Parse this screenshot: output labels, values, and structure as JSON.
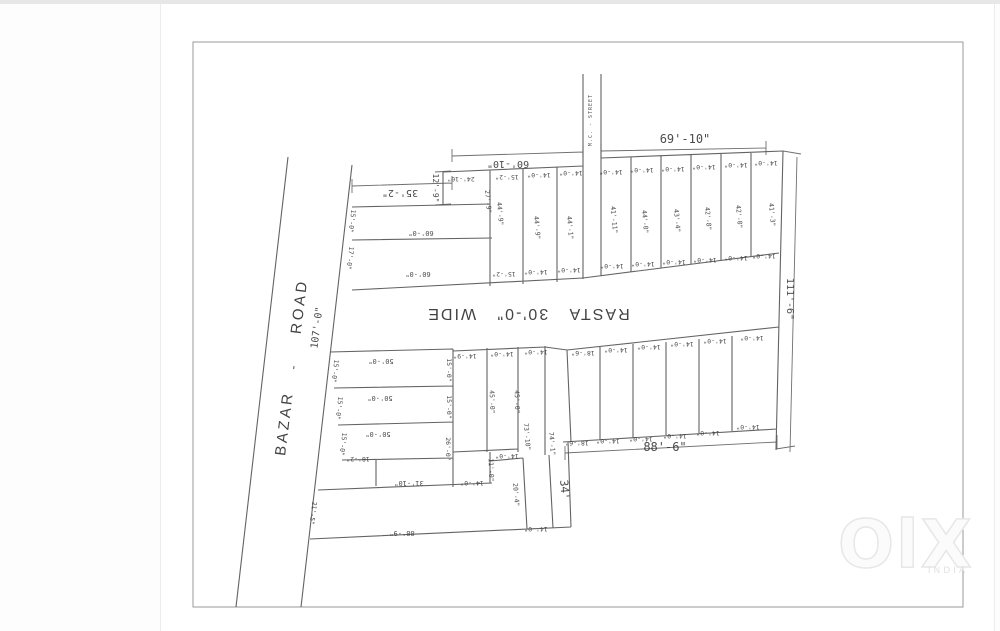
{
  "watermark": {
    "logo": "OlX",
    "country": "INDIA"
  },
  "plan": {
    "road_labels": [
      {
        "t": "BAZAR",
        "x": 289,
        "y": 424,
        "r": -83,
        "s": 15,
        "ls": 3,
        "c": "big"
      },
      {
        "t": "-",
        "x": 297,
        "y": 368,
        "r": -83,
        "s": 12,
        "c": "big"
      },
      {
        "t": "ROAD",
        "x": 304,
        "y": 307,
        "r": -83,
        "s": 15,
        "ls": 3,
        "c": "big"
      },
      {
        "t": "107'-0\"",
        "x": 320,
        "y": 328,
        "r": -83,
        "s": 10
      }
    ],
    "street_labels": [
      {
        "t": "M.C. - STREET",
        "x": 592,
        "y": 120,
        "r": -90,
        "s": 5,
        "ls": 1
      }
    ],
    "rasta_labels": [
      {
        "t": "RASTA   30'-0\"   WIDE",
        "x": 528,
        "y": 309,
        "r": 180,
        "s": 16,
        "ls": 2,
        "c": "big"
      }
    ],
    "boundary_dims": [
      {
        "t": "69'-10\"",
        "x": 685,
        "y": 143,
        "r": 0,
        "s": 12
      },
      {
        "t": "60'-10\"",
        "x": 508,
        "y": 161,
        "r": 180,
        "s": 10
      },
      {
        "t": "35'-2\"",
        "x": 400,
        "y": 190,
        "r": 180,
        "s": 10
      },
      {
        "t": "111'-6\"",
        "x": 787,
        "y": 299,
        "r": 90,
        "s": 10
      },
      {
        "t": "88'-6\"",
        "x": 665,
        "y": 451,
        "r": 0,
        "s": 12
      },
      {
        "t": "88'-9\"",
        "x": 402,
        "y": 531,
        "r": 180,
        "s": 7
      }
    ],
    "plot_labels": [
      {
        "t": "12'-9\"",
        "x": 433,
        "y": 188,
        "r": 90,
        "s": 8
      },
      {
        "t": "24'-10\"",
        "x": 461,
        "y": 177,
        "r": 180,
        "s": 6.5
      },
      {
        "t": "15'-2\"",
        "x": 507,
        "y": 175,
        "r": 180,
        "s": 6.5
      },
      {
        "t": "14'-0\"",
        "x": 539,
        "y": 173,
        "r": 180,
        "s": 6.5
      },
      {
        "t": "14'-0\"",
        "x": 571,
        "y": 171,
        "r": 180,
        "s": 6.5
      },
      {
        "t": "14'-0\"",
        "x": 611,
        "y": 170,
        "r": 180,
        "s": 6.5
      },
      {
        "t": "14'-0\"",
        "x": 642,
        "y": 168,
        "r": 180,
        "s": 6.5
      },
      {
        "t": "14'-0\"",
        "x": 673,
        "y": 167,
        "r": 180,
        "s": 6.5
      },
      {
        "t": "14'-0\"",
        "x": 704,
        "y": 165,
        "r": 180,
        "s": 6.5
      },
      {
        "t": "14'-0\"",
        "x": 736,
        "y": 163,
        "r": 180,
        "s": 6.5
      },
      {
        "t": "14'-0\"",
        "x": 766,
        "y": 161,
        "r": 180,
        "s": 6.5
      },
      {
        "t": "27'-9\"",
        "x": 486,
        "y": 202,
        "r": 85,
        "s": 6.5
      },
      {
        "t": "44'-9\"",
        "x": 498,
        "y": 214,
        "r": 85,
        "s": 6.5
      },
      {
        "t": "44'-9\"",
        "x": 535,
        "y": 228,
        "r": 85,
        "s": 6.5
      },
      {
        "t": "44'-1\"",
        "x": 568,
        "y": 228,
        "r": 85,
        "s": 6.5
      },
      {
        "t": "41'-11\"",
        "x": 612,
        "y": 220,
        "r": 85,
        "s": 6.5
      },
      {
        "t": "44'-0\"",
        "x": 643,
        "y": 222,
        "r": 85,
        "s": 6.5
      },
      {
        "t": "43'-4\"",
        "x": 675,
        "y": 221,
        "r": 85,
        "s": 6.5
      },
      {
        "t": "42'-8\"",
        "x": 706,
        "y": 219,
        "r": 85,
        "s": 6.5
      },
      {
        "t": "42'-0\"",
        "x": 737,
        "y": 217,
        "r": 85,
        "s": 6.5
      },
      {
        "t": "41'-3\"",
        "x": 770,
        "y": 215,
        "r": 85,
        "s": 6.5
      },
      {
        "t": "60'-0\"",
        "x": 421,
        "y": 231,
        "r": 180,
        "s": 7
      },
      {
        "t": "60'-0\"",
        "x": 418,
        "y": 272,
        "r": 180,
        "s": 7
      },
      {
        "t": "15'-0\"",
        "x": 350,
        "y": 221,
        "r": 97,
        "s": 6.5
      },
      {
        "t": "17'-0\"",
        "x": 348,
        "y": 258,
        "r": 97,
        "s": 6.5
      },
      {
        "t": "15'-2\"",
        "x": 504,
        "y": 272,
        "r": 180,
        "s": 6.5
      },
      {
        "t": "14'-0\"",
        "x": 536,
        "y": 270,
        "r": 180,
        "s": 6.5
      },
      {
        "t": "14'-0\"",
        "x": 569,
        "y": 268,
        "r": 180,
        "s": 6.5
      },
      {
        "t": "14'-0\"",
        "x": 612,
        "y": 264,
        "r": 180,
        "s": 6.5
      },
      {
        "t": "14'-0\"",
        "x": 643,
        "y": 262,
        "r": 180,
        "s": 6.5
      },
      {
        "t": "14'-0\"",
        "x": 674,
        "y": 260,
        "r": 180,
        "s": 6.5
      },
      {
        "t": "14'-0\"",
        "x": 705,
        "y": 258,
        "r": 180,
        "s": 6.5
      },
      {
        "t": "14'-0\"",
        "x": 736,
        "y": 256,
        "r": 180,
        "s": 6.5
      },
      {
        "t": "14'-0\"",
        "x": 764,
        "y": 254,
        "r": 180,
        "s": 6.5
      },
      {
        "t": "50'-0\"",
        "x": 381,
        "y": 359,
        "r": 180,
        "s": 7
      },
      {
        "t": "50'-0\"",
        "x": 380,
        "y": 396,
        "r": 180,
        "s": 7
      },
      {
        "t": "50'-0\"",
        "x": 378,
        "y": 432,
        "r": 180,
        "s": 7
      },
      {
        "t": "15'-0\"",
        "x": 333,
        "y": 371,
        "r": 97,
        "s": 6.5
      },
      {
        "t": "15'-0\"",
        "x": 337,
        "y": 408,
        "r": 97,
        "s": 6.5
      },
      {
        "t": "15'-0\"",
        "x": 341,
        "y": 444,
        "r": 97,
        "s": 6.5
      },
      {
        "t": "15'-0\"",
        "x": 447,
        "y": 370,
        "r": 90,
        "s": 6.5
      },
      {
        "t": "15'-0\"",
        "x": 447,
        "y": 407,
        "r": 90,
        "s": 6.5
      },
      {
        "t": "26'-0\"",
        "x": 446,
        "y": 449,
        "r": 90,
        "s": 6.5
      },
      {
        "t": "18'-2\"",
        "x": 358,
        "y": 457,
        "r": 180,
        "s": 6.5
      },
      {
        "t": "31'-10\"",
        "x": 409,
        "y": 481,
        "r": 180,
        "s": 7
      },
      {
        "t": "21'-5\"",
        "x": 311,
        "y": 513,
        "r": 97,
        "s": 6.5
      },
      {
        "t": "14'-9\"",
        "x": 465,
        "y": 354,
        "r": 180,
        "s": 6.5
      },
      {
        "t": "14'-0\"",
        "x": 502,
        "y": 352,
        "r": 180,
        "s": 6.5
      },
      {
        "t": "14'-0\"",
        "x": 536,
        "y": 350,
        "r": 180,
        "s": 6.5
      },
      {
        "t": "45'-0\"",
        "x": 490,
        "y": 402,
        "r": 88,
        "s": 6.5
      },
      {
        "t": "45'-0\"",
        "x": 515,
        "y": 402,
        "r": 88,
        "s": 6.5
      },
      {
        "t": "73'-10\"",
        "x": 525,
        "y": 437,
        "r": 85,
        "s": 6.5
      },
      {
        "t": "74'-1\"",
        "x": 550,
        "y": 444,
        "r": 85,
        "s": 6.5
      },
      {
        "t": "14'-0\"",
        "x": 472,
        "y": 481,
        "r": 180,
        "s": 6.5
      },
      {
        "t": "11'-0\"",
        "x": 489,
        "y": 470,
        "r": 88,
        "s": 6.5
      },
      {
        "t": "14'-0\"",
        "x": 507,
        "y": 454,
        "r": 180,
        "s": 6.5
      },
      {
        "t": "20'-4\"",
        "x": 514,
        "y": 495,
        "r": 85,
        "s": 6.5
      },
      {
        "t": "34'",
        "x": 561,
        "y": 490,
        "r": 85,
        "s": 11
      },
      {
        "t": "14'-0\"",
        "x": 536,
        "y": 527,
        "r": 180,
        "s": 6.5
      },
      {
        "t": "18'-6\"",
        "x": 583,
        "y": 351,
        "r": 180,
        "s": 6.5
      },
      {
        "t": "14'-0\"",
        "x": 616,
        "y": 348,
        "r": 180,
        "s": 6.5
      },
      {
        "t": "14'-0\"",
        "x": 649,
        "y": 345,
        "r": 180,
        "s": 6.5
      },
      {
        "t": "14'-0\"",
        "x": 682,
        "y": 342,
        "r": 180,
        "s": 6.5
      },
      {
        "t": "14'-0\"",
        "x": 715,
        "y": 339,
        "r": 180,
        "s": 6.5
      },
      {
        "t": "14'-0\"",
        "x": 752,
        "y": 336,
        "r": 180,
        "s": 6.5
      },
      {
        "t": "18'-6\"",
        "x": 577,
        "y": 441,
        "r": 180,
        "s": 6.5
      },
      {
        "t": "14'-0\"",
        "x": 608,
        "y": 439,
        "r": 180,
        "s": 6.5
      },
      {
        "t": "14'-0\"",
        "x": 641,
        "y": 437,
        "r": 180,
        "s": 6.5
      },
      {
        "t": "14'-0\"",
        "x": 675,
        "y": 434,
        "r": 180,
        "s": 6.5
      },
      {
        "t": "14'-0\"",
        "x": 708,
        "y": 431,
        "r": 180,
        "s": 6.5
      },
      {
        "t": "14'-0\"",
        "x": 748,
        "y": 425,
        "r": 180,
        "s": 6.5
      }
    ]
  }
}
